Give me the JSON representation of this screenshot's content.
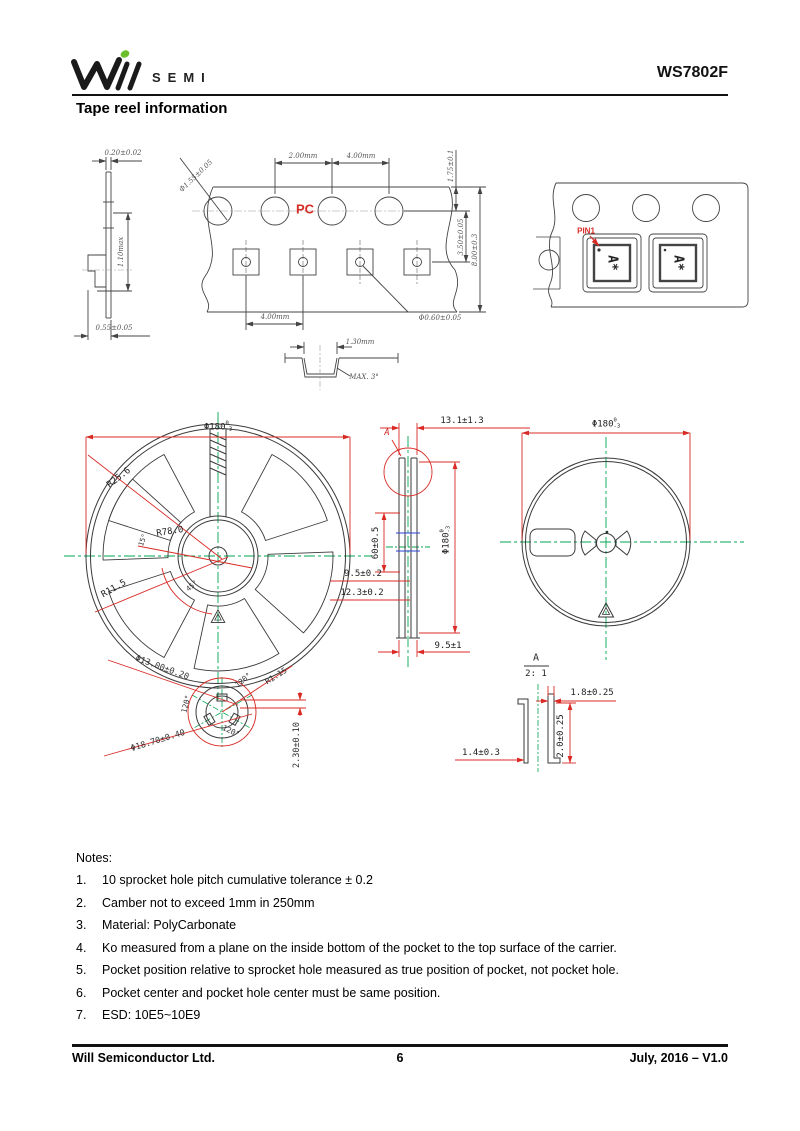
{
  "header": {
    "brand_semi": "SEMI",
    "part_number": "WS7802F"
  },
  "page_title": "Tape reel information",
  "tape_section": {
    "dim_thickness": "0.20±0.02",
    "dim_height": "1.10max",
    "dim_base": "0.55±0.05"
  },
  "tape_top": {
    "material": "PC",
    "dim_hole_pitch": "2.00mm",
    "dim_pocket_span": "4.00mm",
    "dim_hole_dia": "Φ1.55±0.05",
    "dim_edge": "1.75±0.1",
    "dim_hole_to_pocket": "3.50±0.05",
    "dim_width": "8.00±0.3",
    "dim_pocket_pitch": "4.00mm",
    "dim_pocket_hole": "Φ0.60±0.05"
  },
  "pocket_detail": {
    "dim_width": "1.30mm",
    "dim_angle": "MAX. 3°"
  },
  "device_tape": {
    "pin1": "PIN1",
    "marking": "A*"
  },
  "reel_front": {
    "dim_dia": "Φ180",
    "tol_plus": "0",
    "tol_minus": "-3",
    "r_outer": "R25.6",
    "r_mid": "R78.0",
    "r_inner": "R11.5",
    "angle_small": "15°",
    "angle_spoke": "45°"
  },
  "reel_side": {
    "dim_width_top": "13.1±1.3",
    "detail_mark": "A",
    "dim_hub": "60±0.5",
    "dim_dia": "Φ180",
    "tol_plus": "0",
    "tol_minus": "-3",
    "dim_inner1": "9.5±0.2",
    "dim_inner2": "12.3±0.2",
    "dim_bottom": "9.5±1"
  },
  "reel_back": {
    "dim_dia": "Φ180",
    "tol_plus": "0",
    "tol_minus": "-3"
  },
  "hub_detail": {
    "dim_dia_inner": "Φ13.00±0.20",
    "dim_dia_outer": "Φ18.70±0.40",
    "angle1": "120°",
    "angle2": "120°",
    "angle3": "120°",
    "radius": "R1.15",
    "dim_key": "2.30±0.10"
  },
  "detail_a": {
    "label": "A",
    "scale": "2: 1",
    "dim_top": "1.8±0.25",
    "dim_side": "2.0±0.25",
    "dim_left": "1.4±0.3"
  },
  "notes": {
    "title": "Notes:",
    "items": [
      {
        "n": "1.",
        "t": "10 sprocket hole pitch cumulative tolerance ± 0.2"
      },
      {
        "n": "2.",
        "t": "Camber not to exceed 1mm in 250mm"
      },
      {
        "n": "3.",
        "t": "Material: PolyCarbonate"
      },
      {
        "n": "4.",
        "t": "Ko measured from a plane on the inside bottom of the pocket to the top surface of the carrier."
      },
      {
        "n": "5.",
        "t": "Pocket position relative to sprocket hole measured as true position of pocket, not pocket hole."
      },
      {
        "n": "6.",
        "t": "Pocket center and pocket hole center must be same position."
      },
      {
        "n": "7.",
        "t": "ESD: 10E5~10E9"
      }
    ]
  },
  "footer": {
    "company": "Will Semiconductor Ltd.",
    "page": "6",
    "version": "July, 2016 – V1.0"
  }
}
